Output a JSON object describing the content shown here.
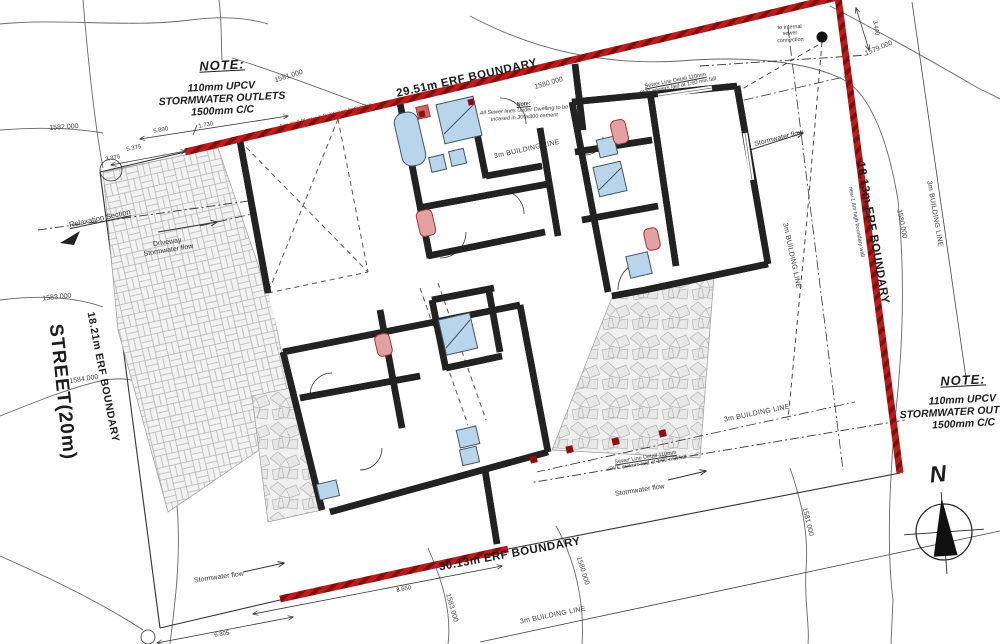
{
  "notes": {
    "left": {
      "title": "NOTE:",
      "lines": [
        "110mm UPCV",
        "STORMWATER OUTLETS",
        "1500mm C/C"
      ]
    },
    "right": {
      "title": "NOTE:",
      "lines": [
        "110mm UPCV",
        "STORMWATER OUTLETS",
        "1500mm C/C"
      ]
    }
  },
  "boundaries": {
    "top": "29.51m ERF BOUNDARY",
    "right": "18.13m ERF BOUNDARY",
    "bottom": "30.13m ERF BOUNDARY",
    "left": "18.21m ERF BOUNDARY",
    "right_wall_note": "new 1.8m high boundary wall"
  },
  "street": "STREET(20m)",
  "compass": {
    "north": "N"
  },
  "labels": {
    "building_line": "3m BUILDING LINE",
    "stormwater_flow": "Stormwater flow",
    "driveway": "Driveway",
    "relaxation": "Relaxation Section"
  },
  "contours": {
    "c1579": "1579.000",
    "c1580_top": "1580.000",
    "c1580_right": "1580.000",
    "c1580_bottom": "1580.000",
    "c1581_top": "1581.000",
    "c1581_bottom": "1581.000",
    "c1582": "1582.000",
    "c1583": "1583.000",
    "c1583_bottom": "1583.000",
    "c1584": "1584.000"
  },
  "sewer": {
    "connection": [
      "to internal",
      "sewer",
      "connection"
    ],
    "dwelling_note_title": "Note:",
    "dwelling_note": [
      "All Sewer lines Under Dwelling to be",
      "incased in 300x300 cement"
    ],
    "detail": [
      "Sewer Line Detail 110mm",
      "uPVC sewers laid at 1:60 min fall"
    ]
  },
  "firewall_note": "Fire Wall Plaster & Painted on both sides",
  "dimensions": {
    "d_3375": "3.375",
    "d_5375": "5.375",
    "d_5890": "5.890",
    "d_1730": "1.730",
    "d_3440": "3.440",
    "d_8650": "8.650",
    "d_6805": "6.805"
  },
  "colors": {
    "boundary_red": "#bf1a1a",
    "boundary_red_dark": "#7e0f0f",
    "wall_red": "#c01818",
    "fixture_blue": "#b9d5ec",
    "fixture_red": "#e2a2a2",
    "paving_line": "#b5b5b5",
    "contour_gray": "#666666"
  }
}
